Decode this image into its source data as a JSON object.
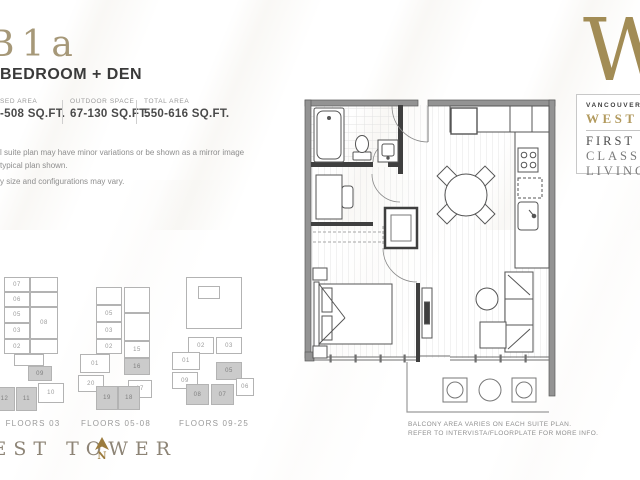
{
  "page": {
    "plan_code": "B1a",
    "plan_title": "BEDROOM + DEN",
    "stats": [
      {
        "label": "SED AREA",
        "value": "-508 SQ.FT."
      },
      {
        "label": "OUTDOOR SPACE",
        "value": "67-130 SQ.FT."
      },
      {
        "label": "TOTAL AREA",
        "value": "550-616 SQ.FT."
      }
    ],
    "disclaimer": [
      "l suite plan may have minor variations or be shown as a mirror image",
      "typical plan shown.",
      "y size and configurations may vary."
    ],
    "tower_label": "WEST TOWER",
    "north_label": "N",
    "balcony_note": [
      "BALCONY AREA VARIES ON EACH SUITE PLAN.",
      "REFER TO INTERVISTA/FLOORPLATE FOR MORE INFO."
    ],
    "logo": {
      "letter": "W",
      "line1": "VANCOUVER",
      "line2": "WEST",
      "line3": "FIRST",
      "line4": "CLASS",
      "line5": "LIVING"
    },
    "colors": {
      "gold": "#a28c55",
      "dark_text": "#3a3a3a",
      "gray_text": "#8f8f8f",
      "shaded_unit": "#cbcbcb"
    }
  },
  "keyplans": [
    {
      "label": "FLOORS 03",
      "label_x": 33,
      "label_y": 419,
      "units": [
        {
          "n": "07",
          "x": 4,
          "y": 277,
          "w": 26,
          "h": 15,
          "shaded": false
        },
        {
          "n": "06",
          "x": 4,
          "y": 292,
          "w": 26,
          "h": 15,
          "shaded": false
        },
        {
          "n": "05",
          "x": 4,
          "y": 307,
          "w": 26,
          "h": 16,
          "shaded": false
        },
        {
          "n": "03",
          "x": 4,
          "y": 323,
          "w": 26,
          "h": 16,
          "shaded": false
        },
        {
          "n": "02",
          "x": 4,
          "y": 339,
          "w": 26,
          "h": 15,
          "shaded": false
        },
        {
          "n": "",
          "x": 30,
          "y": 277,
          "w": 28,
          "h": 15,
          "shaded": false
        },
        {
          "n": "",
          "x": 30,
          "y": 292,
          "w": 28,
          "h": 15,
          "shaded": false
        },
        {
          "n": "08",
          "x": 30,
          "y": 307,
          "w": 28,
          "h": 32,
          "shaded": false
        },
        {
          "n": "",
          "x": 30,
          "y": 339,
          "w": 28,
          "h": 15,
          "shaded": false
        },
        {
          "n": "",
          "x": 14,
          "y": 354,
          "w": 30,
          "h": 12,
          "shaded": false
        },
        {
          "n": "09",
          "x": 28,
          "y": 366,
          "w": 24,
          "h": 15,
          "shaded": true
        },
        {
          "n": "10",
          "x": 38,
          "y": 383,
          "w": 26,
          "h": 20,
          "shaded": false
        },
        {
          "n": "11",
          "x": 16,
          "y": 387,
          "w": 21,
          "h": 24,
          "shaded": true
        },
        {
          "n": "12",
          "x": -6,
          "y": 387,
          "w": 21,
          "h": 24,
          "shaded": true
        }
      ]
    },
    {
      "label": "FLOORS 05-08",
      "label_x": 116,
      "label_y": 419,
      "units": [
        {
          "n": "",
          "x": 96,
          "y": 287,
          "w": 26,
          "h": 18,
          "shaded": false
        },
        {
          "n": "05",
          "x": 96,
          "y": 305,
          "w": 26,
          "h": 17,
          "shaded": false
        },
        {
          "n": "03",
          "x": 96,
          "y": 322,
          "w": 26,
          "h": 17,
          "shaded": false
        },
        {
          "n": "02",
          "x": 96,
          "y": 339,
          "w": 26,
          "h": 15,
          "shaded": false
        },
        {
          "n": "01",
          "x": 80,
          "y": 354,
          "w": 30,
          "h": 19,
          "shaded": false
        },
        {
          "n": "20",
          "x": 78,
          "y": 375,
          "w": 26,
          "h": 17,
          "shaded": false
        },
        {
          "n": "",
          "x": 124,
          "y": 287,
          "w": 26,
          "h": 26,
          "shaded": false
        },
        {
          "n": "",
          "x": 124,
          "y": 313,
          "w": 26,
          "h": 28,
          "shaded": false
        },
        {
          "n": "15",
          "x": 124,
          "y": 341,
          "w": 26,
          "h": 17,
          "shaded": false
        },
        {
          "n": "16",
          "x": 124,
          "y": 358,
          "w": 26,
          "h": 17,
          "shaded": true
        },
        {
          "n": "17",
          "x": 128,
          "y": 380,
          "w": 24,
          "h": 18,
          "shaded": false
        },
        {
          "n": "19",
          "x": 96,
          "y": 386,
          "w": 22,
          "h": 24,
          "shaded": true
        },
        {
          "n": "18",
          "x": 118,
          "y": 386,
          "w": 22,
          "h": 24,
          "shaded": true
        }
      ]
    },
    {
      "label": "FLOORS 09-25",
      "label_x": 214,
      "label_y": 419,
      "units": [
        {
          "n": "",
          "x": 186,
          "y": 277,
          "w": 56,
          "h": 52,
          "shaded": false
        },
        {
          "n": "",
          "x": 198,
          "y": 286,
          "w": 22,
          "h": 13,
          "shaded": false
        },
        {
          "n": "02",
          "x": 188,
          "y": 337,
          "w": 26,
          "h": 17,
          "shaded": false
        },
        {
          "n": "03",
          "x": 216,
          "y": 337,
          "w": 26,
          "h": 17,
          "shaded": false
        },
        {
          "n": "01",
          "x": 172,
          "y": 352,
          "w": 28,
          "h": 18,
          "shaded": false
        },
        {
          "n": "05",
          "x": 216,
          "y": 362,
          "w": 26,
          "h": 18,
          "shaded": true
        },
        {
          "n": "09",
          "x": 172,
          "y": 372,
          "w": 26,
          "h": 17,
          "shaded": false
        },
        {
          "n": "08",
          "x": 186,
          "y": 384,
          "w": 23,
          "h": 21,
          "shaded": true
        },
        {
          "n": "07",
          "x": 211,
          "y": 384,
          "w": 23,
          "h": 21,
          "shaded": true
        },
        {
          "n": "06",
          "x": 236,
          "y": 378,
          "w": 18,
          "h": 18,
          "shaded": false
        }
      ]
    }
  ]
}
